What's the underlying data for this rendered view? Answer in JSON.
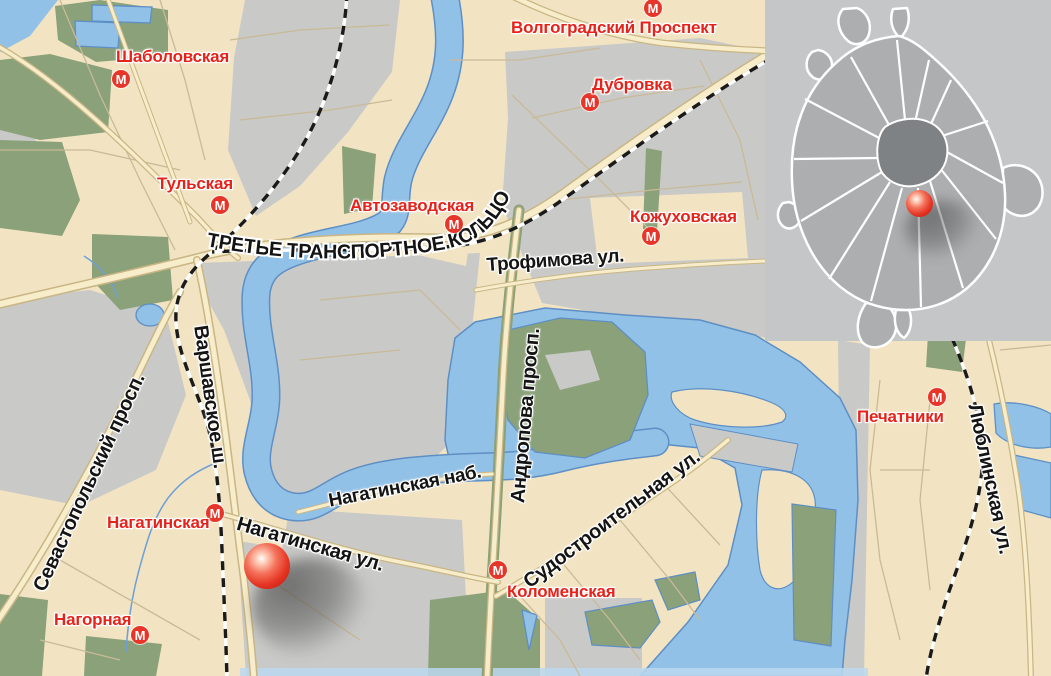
{
  "map": {
    "title": "Схема проезда — район Нагатино, Москва",
    "metro_letter": "М",
    "stations": [
      {
        "name": "Шаболовская"
      },
      {
        "name": "Тульская"
      },
      {
        "name": "Автозаводская"
      },
      {
        "name": "Волгоградский Проспект"
      },
      {
        "name": "Дубровка"
      },
      {
        "name": "Кожуховская"
      },
      {
        "name": "Нагатинская"
      },
      {
        "name": "Нагорная"
      },
      {
        "name": "Коломенская"
      },
      {
        "name": "Печатники"
      }
    ],
    "streets": {
      "ttk": "ТРЕТЬЕ ТРАНСПОРТНОЕ КОЛЬЦО",
      "trofimova": "Трофимова ул.",
      "sevastopolsky": "Севастопольский просп.",
      "varshavskoe": "Варшавское ш.",
      "nagatinskaya_nab": "Нагатинская наб.",
      "andropova": "Андропова просп.",
      "nagatinskaya_ul": "Нагатинская ул.",
      "sudostroitelnaya": "Судостроительная ул.",
      "lyublinskaya": "Люблинская ул."
    },
    "marker": {
      "description": "красный шар — местоположение объекта"
    },
    "inset": {
      "description": "обзорная карта Москвы с отметкой местоположения"
    },
    "colors": {
      "land": "#F2E4C3",
      "blocks": "#C9C9C8",
      "park": "#8AA179",
      "water": "#92C1E7",
      "water_edge": "#5E8FC4",
      "road_fill": "#F7EDCB",
      "road_casing": "#C9B684",
      "railway": "#1A1A1A",
      "metro_red": "#E8352A",
      "station_label_red": "#E5231B",
      "street_label_black": "#141414",
      "inset_bg": "#C5C6C8",
      "inset_city": "#ACAEB0",
      "inset_center": "#7F8284",
      "marker_red": "#E63726"
    }
  }
}
